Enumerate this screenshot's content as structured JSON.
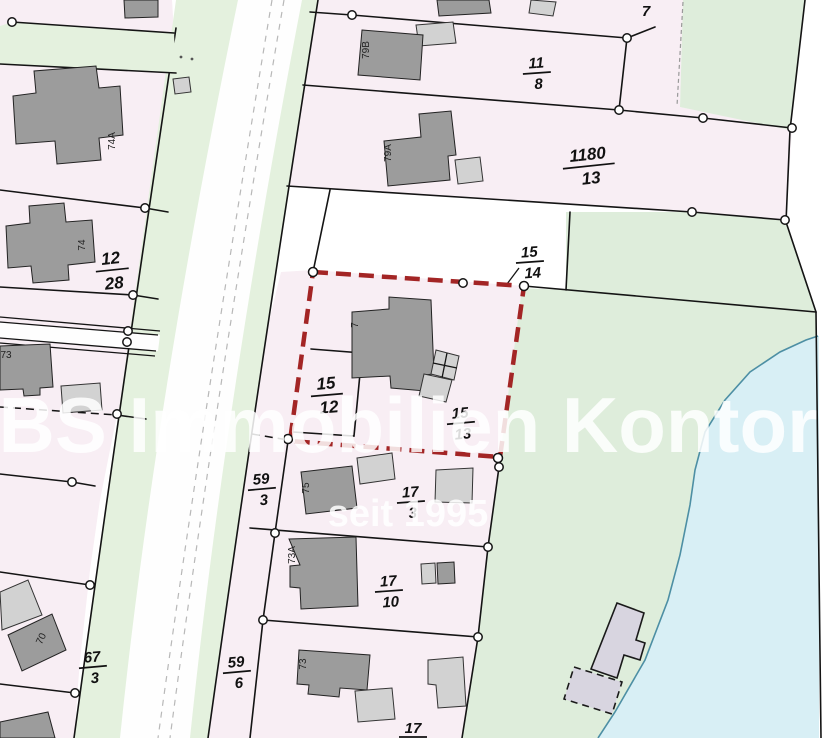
{
  "map": {
    "watermark": {
      "line1": "BS Immobilien Kontor",
      "line2": "seit 1995"
    },
    "parcel_labels": {
      "p7_top": "7",
      "p11_8": {
        "num": "11",
        "den": "8"
      },
      "p1180_13": {
        "num": "1180",
        "den": "13"
      },
      "p12_28": {
        "num": "12",
        "den": "28"
      },
      "p15_14": {
        "num": "15",
        "den": "14"
      },
      "p15_12": {
        "num": "15",
        "den": "12"
      },
      "p15_13": {
        "num": "15",
        "den": "13"
      },
      "p59_3": {
        "num": "59",
        "den": "3"
      },
      "p17_3": {
        "num": "17",
        "den": "3"
      },
      "p17_10": {
        "num": "17",
        "den": "10"
      },
      "p67_3": {
        "num": "67",
        "den": "3"
      },
      "p59_6": {
        "num": "59",
        "den": "6"
      },
      "p17_bottom": {
        "num": "17"
      }
    },
    "building_labels": {
      "b74A": "74A",
      "b74": "74",
      "b73_left": "73",
      "b70": "70",
      "b79B": "79B",
      "b79A": "79A",
      "b7": "7",
      "b75": "75",
      "b73A": "73A",
      "b73": "73"
    },
    "colors": {
      "parcel_pink": "#f8eef4",
      "road_verge_green": "#e4f1de",
      "grass_green": "#deeddb",
      "pond_blue": "#d8eff5",
      "pond_outline": "#4d8fa4",
      "building_dark": "#9c9c9c",
      "building_light": "#d2d2d2",
      "building_pond_area": "#d8d5e0",
      "highlight_red": "#a32525",
      "boundary_black": "#141414",
      "watermark_white": "rgba(255,255,255,0.85)"
    }
  }
}
